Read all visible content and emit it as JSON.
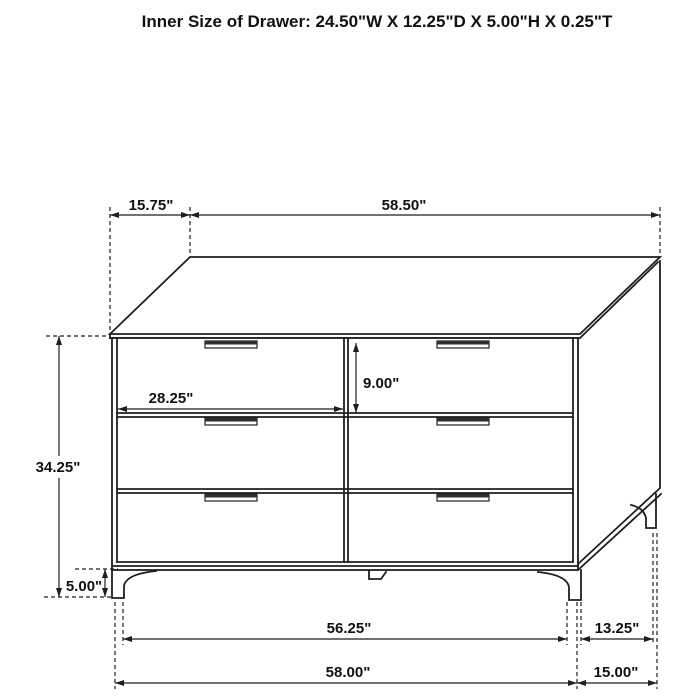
{
  "title": "Inner Size of Drawer: 24.50\"W X 12.25\"D X 5.00\"H X 0.25\"T",
  "diagram": {
    "object": "six-drawer-dresser-dimension-drawing",
    "colors": {
      "line": "#1f1f1f",
      "background": "#ffffff"
    }
  },
  "dimensions": {
    "top_depth": "15.75\"",
    "top_width": "58.50\"",
    "drawer_width": "28.25\"",
    "drawer_height": "9.00\"",
    "body_height": "34.25\"",
    "leg_height": "5.00\"",
    "width_between_legs": "56.25\"",
    "overall_width": "58.00\"",
    "depth_between_legs": "13.25\"",
    "overall_depth": "15.00\""
  }
}
